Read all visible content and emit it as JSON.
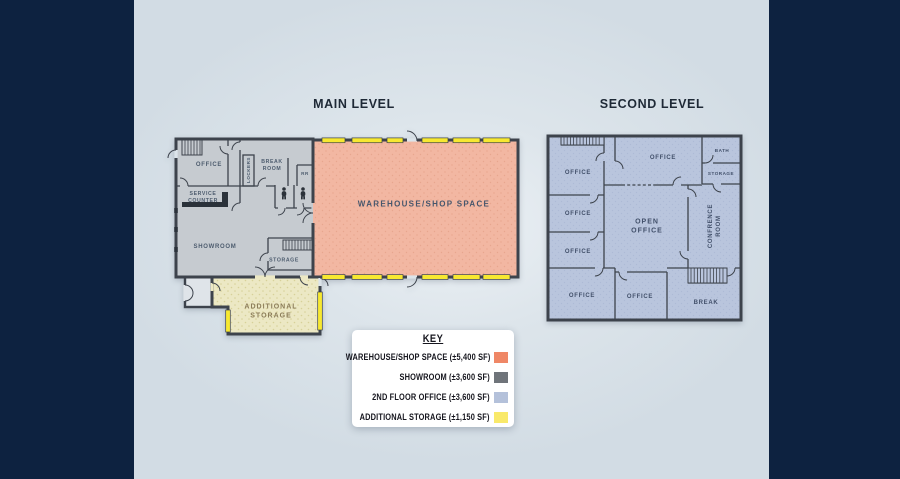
{
  "main_level": {
    "title": "MAIN LEVEL",
    "rooms": [
      {
        "id": "office",
        "label": "OFFICE"
      },
      {
        "id": "service-counter",
        "label": "SERVICE COUNTER"
      },
      {
        "id": "lockers",
        "label": "LOCKERS"
      },
      {
        "id": "break-room",
        "label": "BREAK ROOM"
      },
      {
        "id": "rr",
        "label": "RR"
      },
      {
        "id": "showroom",
        "label": "SHOWROOM"
      },
      {
        "id": "storage",
        "label": "STORAGE"
      },
      {
        "id": "warehouse",
        "label": "WAREHOUSE/SHOP SPACE"
      },
      {
        "id": "additional-storage",
        "label": "ADDITIONAL STORAGE"
      }
    ]
  },
  "second_level": {
    "title": "SECOND LEVEL",
    "rooms": [
      {
        "id": "office-top-left",
        "label": "OFFICE"
      },
      {
        "id": "office-left-2",
        "label": "OFFICE"
      },
      {
        "id": "office-left-3",
        "label": "OFFICE"
      },
      {
        "id": "office-bottom-left",
        "label": "OFFICE"
      },
      {
        "id": "office-bottom-middle",
        "label": "OFFICE"
      },
      {
        "id": "office-top-middle",
        "label": "OFFICE"
      },
      {
        "id": "open-office",
        "label": "OPEN OFFICE"
      },
      {
        "id": "bath",
        "label": "BATH"
      },
      {
        "id": "storage",
        "label": "STORAGE"
      },
      {
        "id": "conference-room",
        "label": "CONFRENCE ROOM"
      },
      {
        "id": "break",
        "label": "BREAK"
      }
    ]
  },
  "key": {
    "title": "KEY",
    "entries": [
      {
        "label": "WAREHOUSE/SHOP SPACE (±5,400 SF)",
        "color": "#ef8766"
      },
      {
        "label": "SHOWROOM (±3,600 SF)",
        "color": "#6f747a"
      },
      {
        "label": "2ND FLOOR OFFICE (±3,600 SF)",
        "color": "#b4c1da"
      },
      {
        "label": "ADDITIONAL STORAGE (±1,150 SF)",
        "color": "#f9e96a"
      }
    ]
  },
  "colors": {
    "sidebar_navy": "#0d2240",
    "canvas_light": "#dde5eb",
    "wall": "#3d434c",
    "main_gray_fill": "#c6cbd0",
    "warehouse_fill": "#f2b7a2",
    "additional_storage_fill": "#ece8c4",
    "second_level_fill": "#b9c5dd",
    "window_yellow": "#f7e831"
  }
}
